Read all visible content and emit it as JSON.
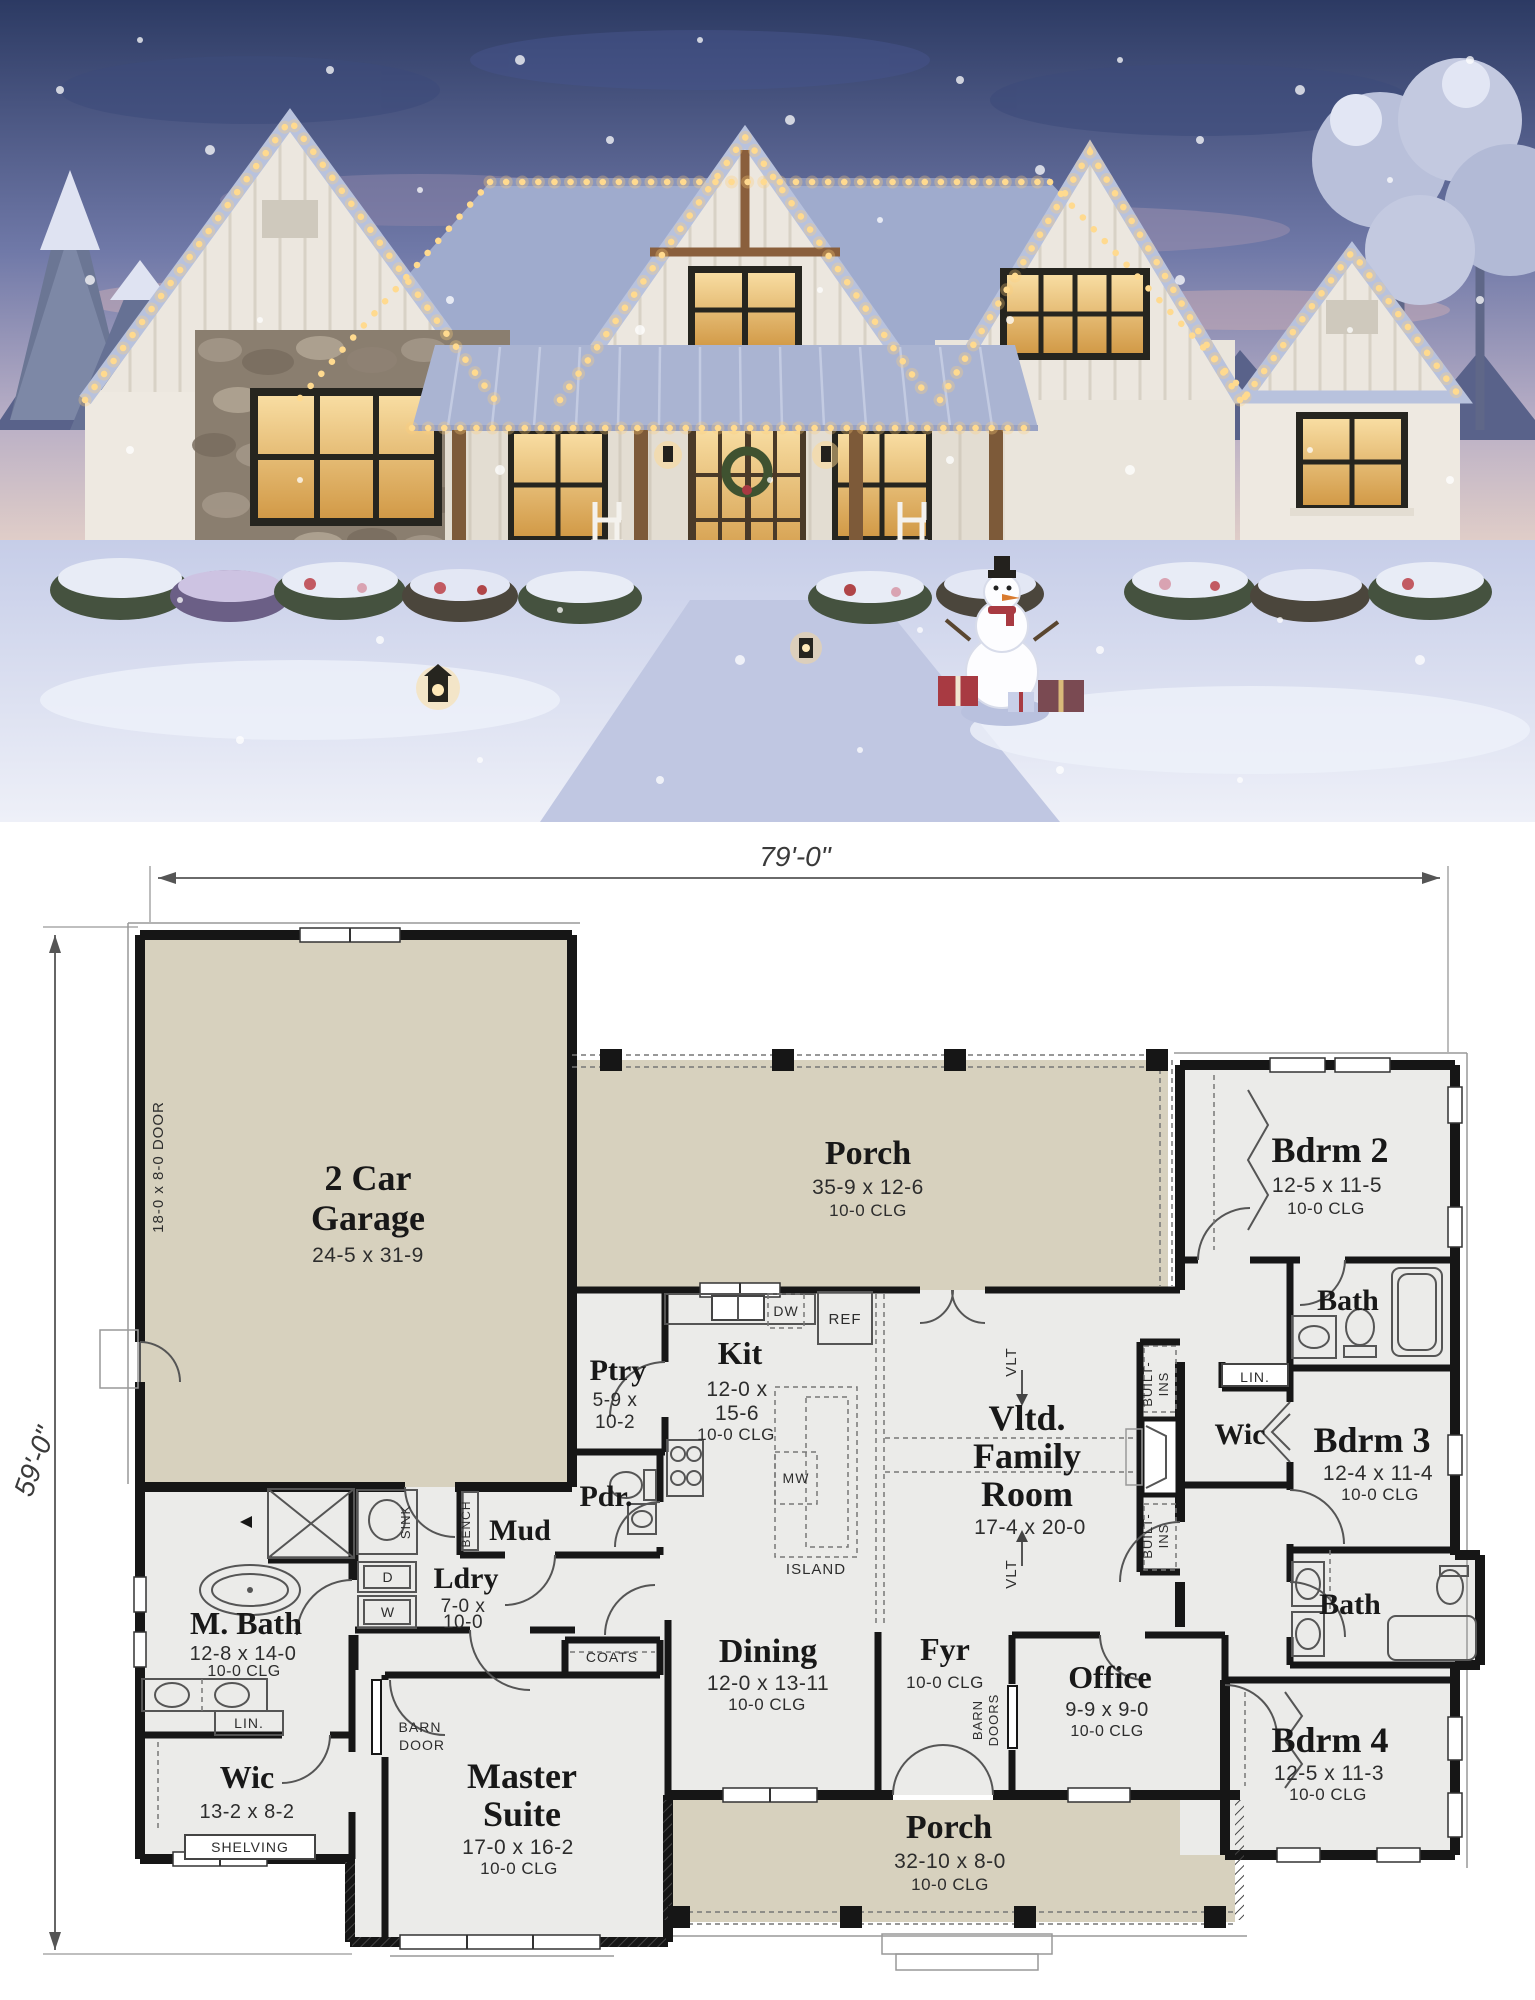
{
  "plan": {
    "dimensions": {
      "width": "79'-0\"",
      "height": "59'-0\""
    },
    "rooms": {
      "garage": {
        "name_line1": "2 Car",
        "name_line2": "Garage",
        "size": "24-5 x 31-9",
        "door_note": "18-0 x 8-0 DOOR"
      },
      "porch_top": {
        "name": "Porch",
        "size": "35-9 x 12-6",
        "clg": "10-0 CLG"
      },
      "bdrm2": {
        "name": "Bdrm 2",
        "size": "12-5 x 11-5",
        "clg": "10-0 CLG"
      },
      "bath2": {
        "name": "Bath"
      },
      "ptry": {
        "name": "Ptry",
        "size_line1": "5-9 x",
        "size_line2": "10-2"
      },
      "kit": {
        "name": "Kit",
        "size_line1": "12-0 x",
        "size_line2": "15-6",
        "clg": "10-0 CLG"
      },
      "family": {
        "name_line1": "Vltd.",
        "name_line2": "Family",
        "name_line3": "Room",
        "size": "17-4 x 20-0"
      },
      "wic_right": {
        "name": "Wic"
      },
      "bdrm3": {
        "name": "Bdrm 3",
        "size": "12-4 x 11-4",
        "clg": "10-0 CLG"
      },
      "bath3": {
        "name": "Bath"
      },
      "pdr": {
        "name": "Pdr."
      },
      "mud": {
        "name": "Mud"
      },
      "ldry": {
        "name": "Ldry",
        "size_line1": "7-0 x",
        "size_line2": "10-0"
      },
      "mbath": {
        "name": "M. Bath",
        "size": "12-8 x 14-0",
        "clg": "10-0 CLG"
      },
      "wic_left": {
        "name": "Wic",
        "size": "13-2 x 8-2"
      },
      "master": {
        "name_line1": "Master",
        "name_line2": "Suite",
        "size": "17-0 x 16-2",
        "clg": "10-0 CLG"
      },
      "dining": {
        "name": "Dining",
        "size": "12-0 x 13-11",
        "clg": "10-0 CLG"
      },
      "fyr": {
        "name": "Fyr",
        "clg": "10-0 CLG"
      },
      "office": {
        "name": "Office",
        "size": "9-9 x 9-0",
        "clg": "10-0 CLG"
      },
      "bdrm4": {
        "name": "Bdrm 4",
        "size": "12-5 x 11-3",
        "clg": "10-0 CLG"
      },
      "porch_bottom": {
        "name": "Porch",
        "size": "32-10 x 8-0",
        "clg": "10-0 CLG"
      }
    },
    "annotations": {
      "ref": "REF",
      "dw": "DW",
      "mw": "MW",
      "island": "ISLAND",
      "sink": "SINK",
      "bench": "BENCH",
      "dryer": "D",
      "washer": "W",
      "lin_right": "LIN.",
      "lin_mbath": "LIN.",
      "built_ins_l1": "BUILT-",
      "built_ins_l2": "INS",
      "vlt_top": "VLT",
      "vlt_bottom": "VLT",
      "barn_door_l1": "BARN",
      "barn_door_l2": "DOOR",
      "barn_doors_l1": "BARN",
      "barn_doors_l2": "DOORS",
      "coats": "COATS",
      "shelving": "SHELVING"
    },
    "colors": {
      "porch_fill": "#d7d1be",
      "room_fill": "#ebebe9",
      "wall": "#161616"
    }
  },
  "photo": {
    "colors": {
      "sky_top": "#2c3a63",
      "sky_low": "#b9afc6",
      "roof": "#9fabcd",
      "siding": "#eee9e1",
      "stone": "#8a7e6f",
      "window_glow": "#f2c670",
      "lights": "#ffd98f",
      "snow": "#dde2f2"
    }
  }
}
